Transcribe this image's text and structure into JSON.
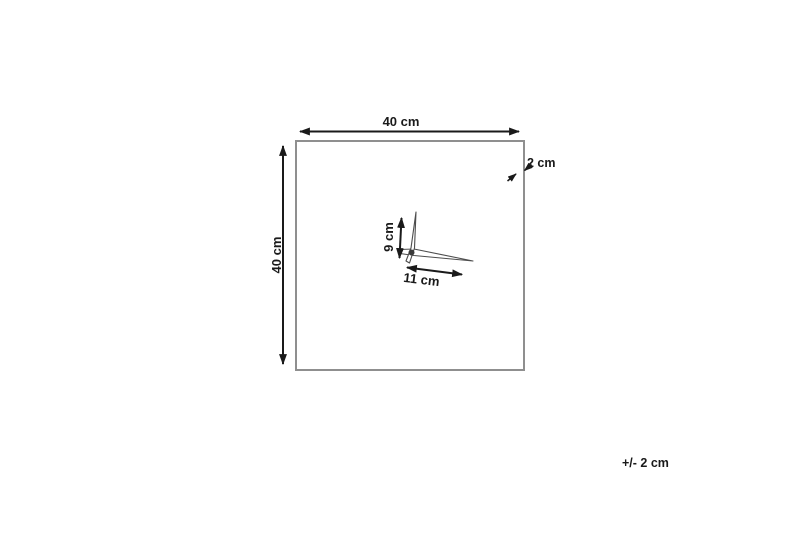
{
  "diagram": {
    "type": "product-dimensions",
    "labels": {
      "width": "40 cm",
      "height": "40 cm",
      "depth": "2 cm",
      "minute_hand_length": "9 cm",
      "hour_hand_length": "11 cm",
      "tolerance": "+/- 2 cm"
    },
    "colors": {
      "line": "#1a1a1a",
      "frame": "#8f8f8f",
      "hand_outline": "#4d4d4d",
      "background": "#ffffff"
    }
  }
}
